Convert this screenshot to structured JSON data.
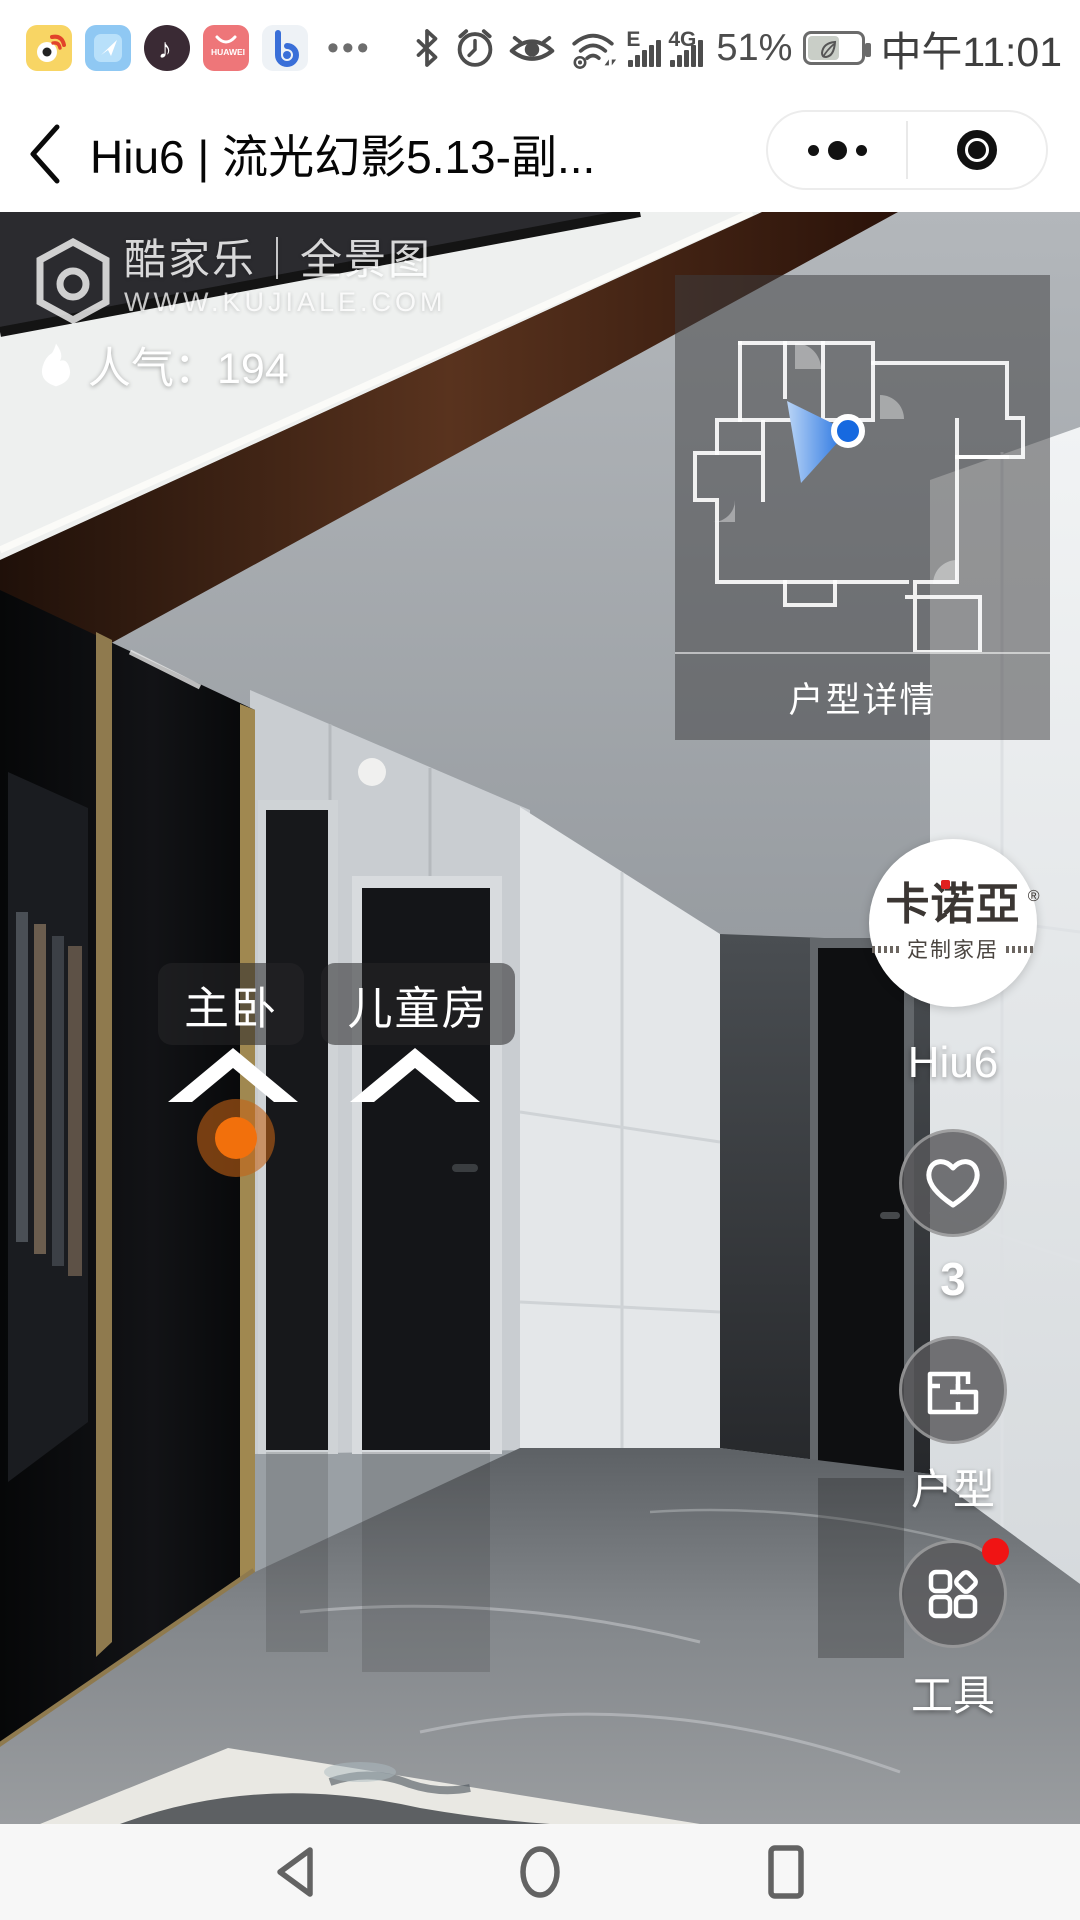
{
  "status_bar": {
    "app_icons": [
      "weibo-icon",
      "messenger-icon",
      "tiktok-icon",
      "huawei-store-icon",
      "browser-icon"
    ],
    "overflow": "•••",
    "network_2g": "E",
    "network_4g": "4G",
    "battery_percent": "51%",
    "time": "中午11:01",
    "icons": [
      "bluetooth-icon",
      "alarm-icon",
      "eye-comfort-icon",
      "wifi-icon",
      "battery-saver-leaf-icon"
    ]
  },
  "header": {
    "title": "Hiu6 | 流光幻影5.13-副...",
    "back": "back-chevron",
    "capsule": {
      "more": "more-options",
      "exit": "exit-circle"
    }
  },
  "pano": {
    "watermark": {
      "line1": "酷家乐｜全景图",
      "line2": "WWW.KUJIALE.COM"
    },
    "popularity": {
      "label": "人气：",
      "value": "194",
      "full": "人气：194"
    },
    "minimap_label": "户型详情",
    "room_labels": [
      "主卧",
      "儿童房"
    ],
    "brand": {
      "line1": "卡诺亞",
      "reg": "®",
      "line2": "定制家居"
    },
    "scene_name": "Hiu6",
    "actions": {
      "favorite_count": "3",
      "floorplan_label": "户型",
      "tools_label": "工具"
    }
  },
  "navbar": {
    "icons": [
      "back-triangle-icon",
      "home-circle-icon",
      "recents-square-icon"
    ]
  },
  "colors": {
    "accent_orange": "#f2700c",
    "cone_blue": "#2f7fe8",
    "dot_blue": "#1669e0",
    "notification_red": "#f01414",
    "brand_red": "#e02020",
    "overlay_dark": "rgba(62,62,64,0.52)"
  }
}
